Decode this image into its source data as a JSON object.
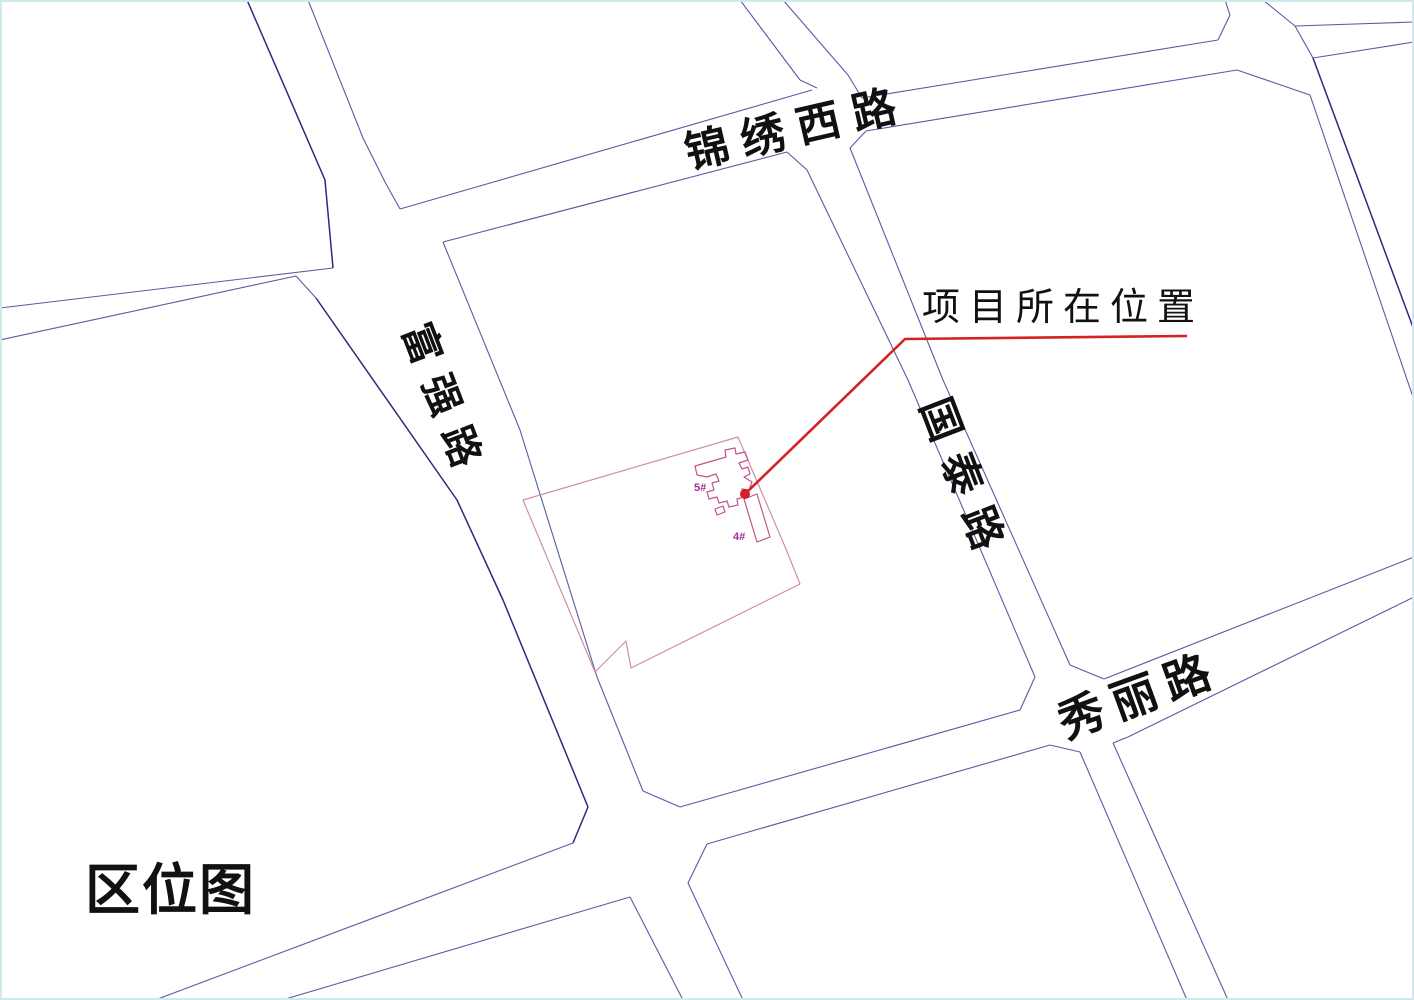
{
  "title": {
    "text": "区位图"
  },
  "annotation": {
    "text": "项目所在位置"
  },
  "roads": {
    "jinxiu": {
      "name": "锦绣西路"
    },
    "fuqiang": {
      "name": "富强路"
    },
    "guotai": {
      "name": "国泰路"
    },
    "xiuli": {
      "name": "秀丽路"
    }
  },
  "site": {
    "buildings": [
      {
        "label": "5#"
      },
      {
        "label": "4#"
      }
    ]
  },
  "colors": {
    "road_line": "#5a5aa5",
    "road_line_dark": "#2b2b7d",
    "site_boundary": "#cf8fa5",
    "building_outline": "#c2558b",
    "building_label": "#a0309a",
    "leader_red": "#d42222",
    "frame": "#cfe9ec",
    "ink": "#111111"
  }
}
